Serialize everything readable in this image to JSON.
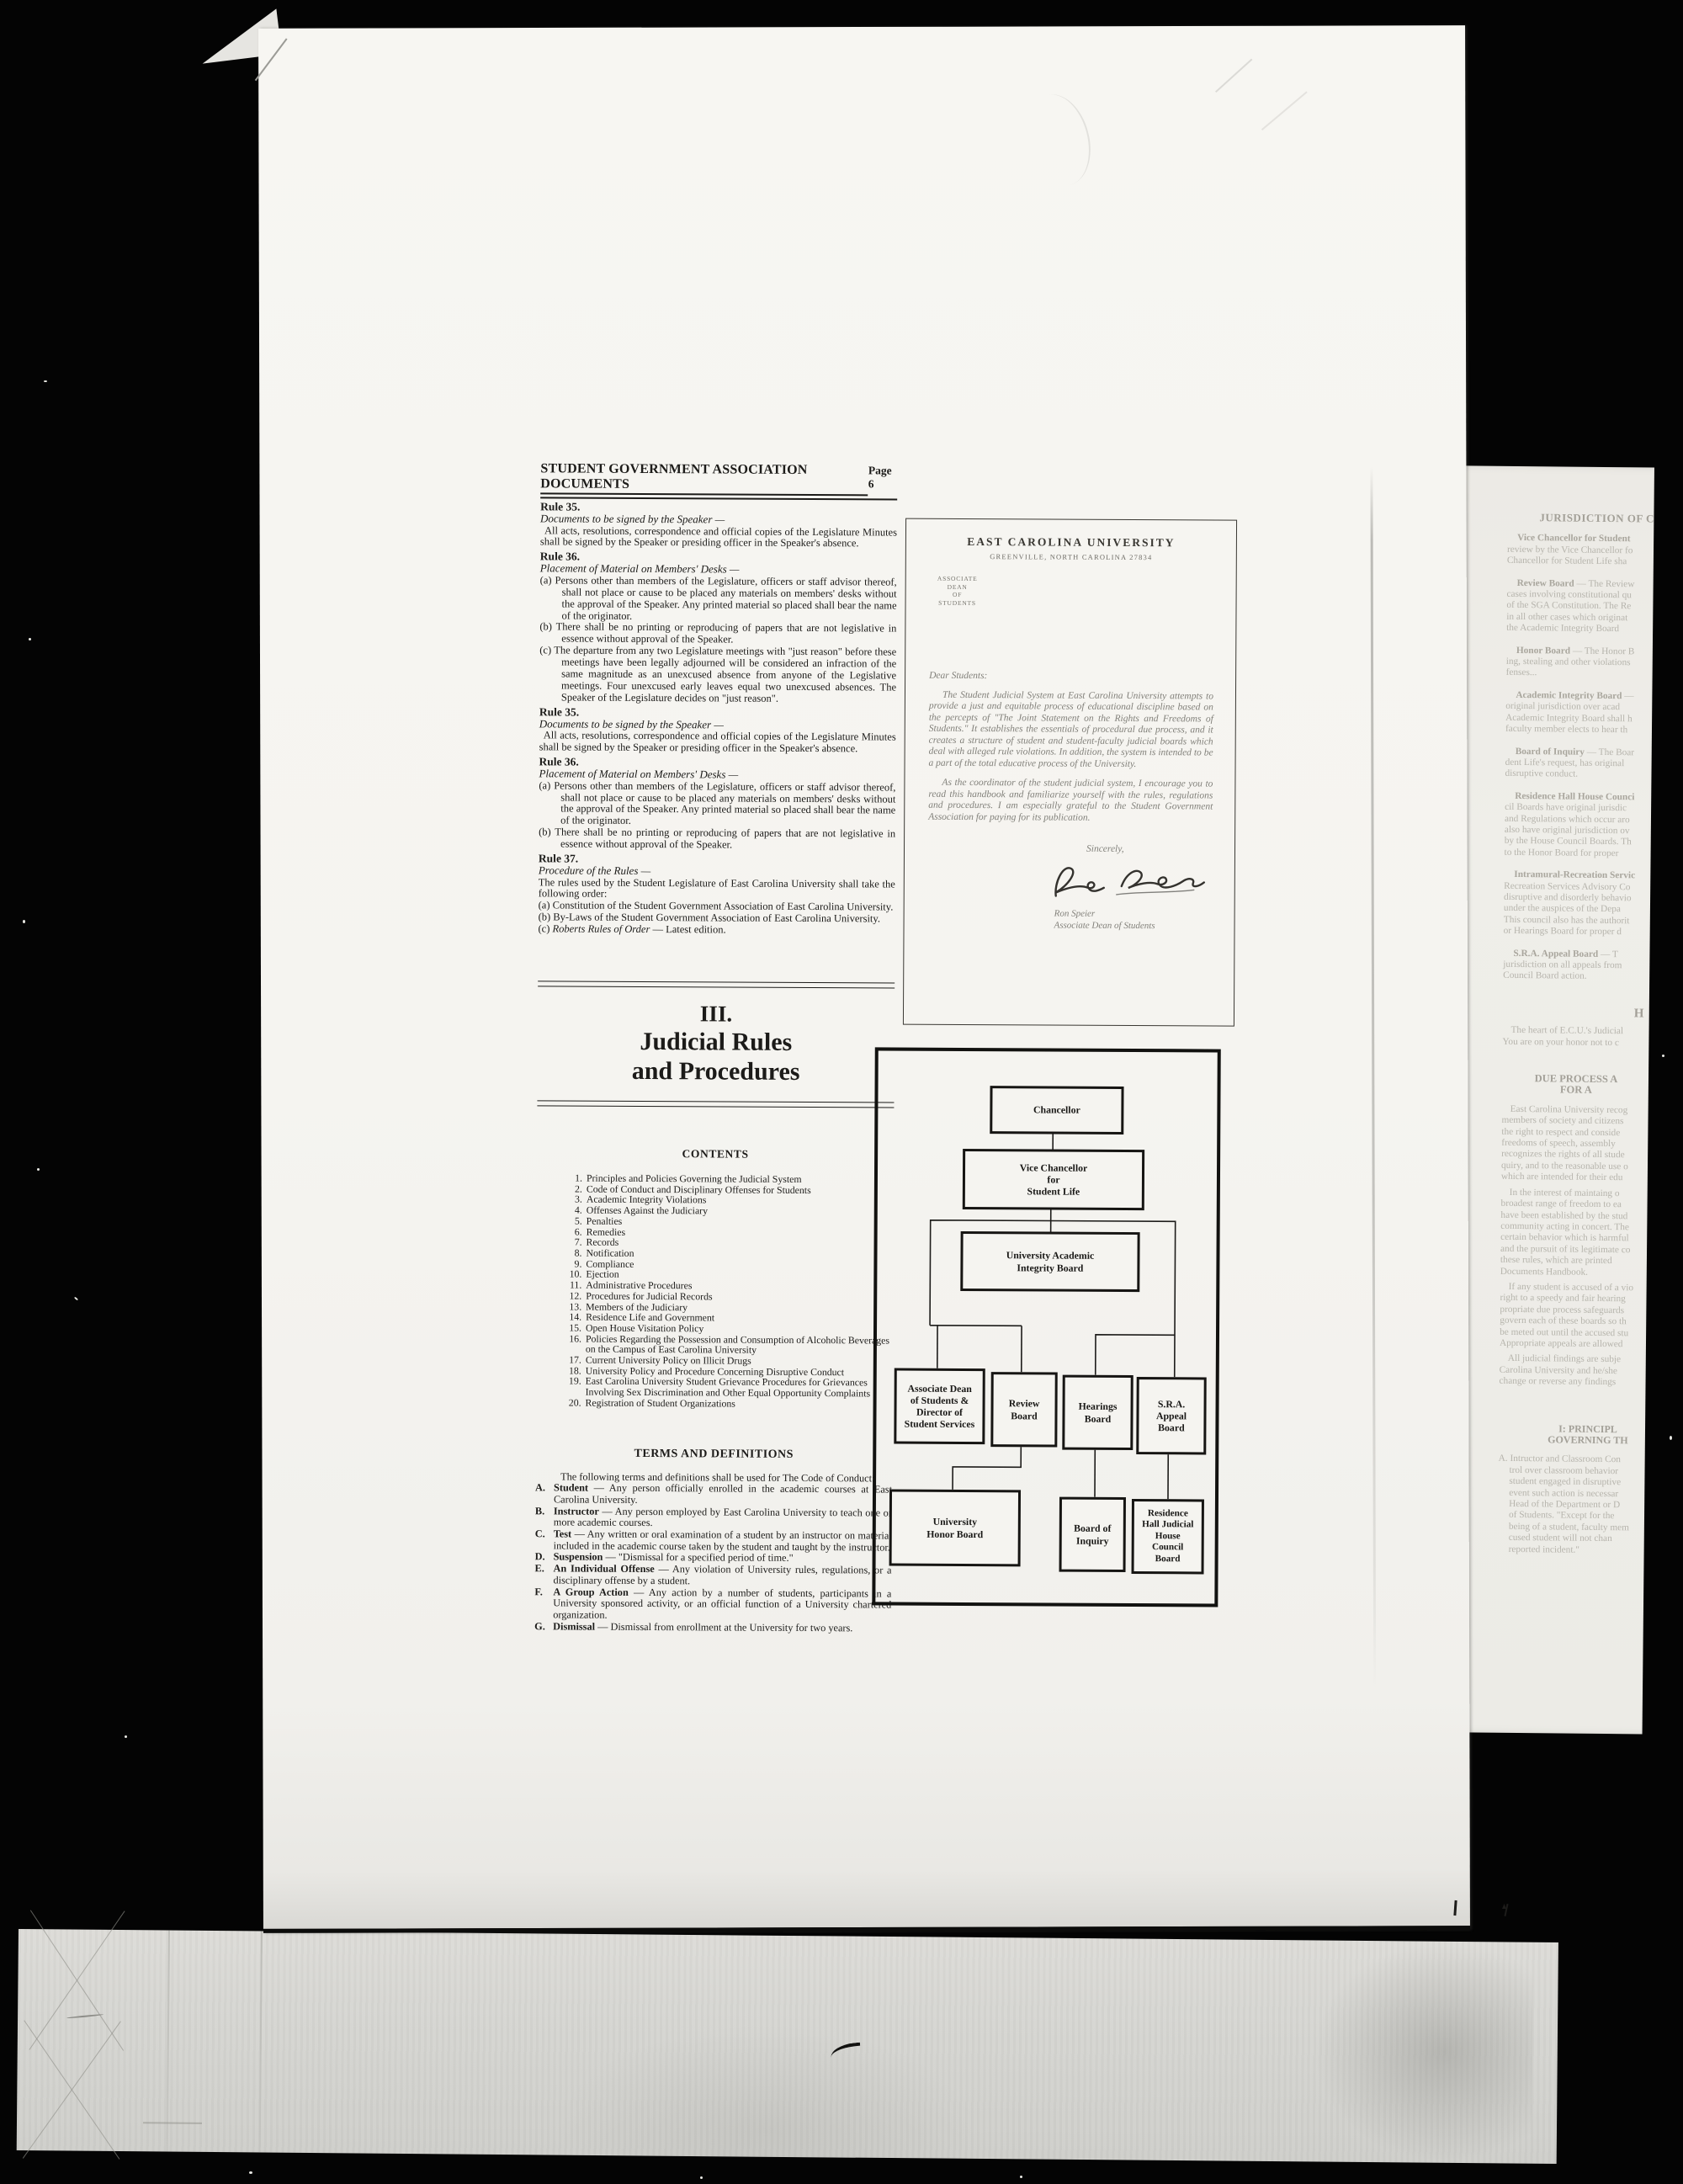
{
  "document_header": {
    "title": "STUDENT GOVERNMENT ASSOCIATION DOCUMENTS",
    "page_label": "Page 6"
  },
  "rules": {
    "r1_h": "Rule 35.",
    "r1_i": "Documents to be signed by the Speaker —",
    "r1_p": "All acts, resolutions, correspondence and official copies of the Legislature Minutes shall be signed by the Speaker or presiding officer in the Speaker's absence.",
    "r2_h": "Rule 36.",
    "r2_i": "Placement of Material on Members' Desks —",
    "r2_a": "(a) Persons other than members of the Legislature, officers or staff advisor thereof, shall not place or cause to be placed any materials on members' desks without the approval of the Speaker. Any printed material so placed shall bear the name of the originator.",
    "r2_b": "(b) There shall be no printing or reproducing of papers that are not legislative in essence without approval of the Speaker.",
    "r2_c": "(c) The departure from any two Legislature meetings with \"just reason\" before these meetings have been legally adjourned will be considered an infraction of the same magnitude as an unexcused absence from anyone of the Legislative meetings.  Four unexcused early leaves equal two unexcused absences.  The Speaker of the Legislature decides on \"just reason\".",
    "r3_h": "Rule 35.",
    "r3_i": "Documents to be signed by the Speaker —",
    "r3_p": "All acts, resolutions, correspondence and official copies of the Legislature Minutes shall be signed by the Speaker or presiding officer in the Speaker's absence.",
    "r4_h": "Rule 36.",
    "r4_i": "Placement of Material on Members' Desks —",
    "r4_a": "(a) Persons other than members of the Legislature, officers or staff advisor thereof, shall not place or cause to be placed any materials on members' desks without the approval of the Speaker. Any printed material so placed shall bear the name of the originator.",
    "r4_b": "(b) There shall be no printing or reproducing of papers that are not legislative in essence without approval of the Speaker.",
    "r5_h": "Rule 37.",
    "r5_i": "Procedure of the Rules —",
    "r5_p": "The rules used by the Student Legislature of East Carolina University shall take the following order:",
    "r5_a": "(a) Constitution of the Student Government Association of East Carolina University.",
    "r5_b": "(b) By-Laws of the Student Government Association of East Carolina University.",
    "r5_c_prefix": "(c) ",
    "r5_c_italic": "Roberts Rules of Order",
    "r5_c_rest": " — Latest edition."
  },
  "section_heading": {
    "numeral": "III.",
    "line1": "Judicial Rules",
    "line2": "and Procedures"
  },
  "contents": {
    "heading": "CONTENTS",
    "items": [
      {
        "n": "1.",
        "t": "Principles and Policies Governing the Judicial System"
      },
      {
        "n": "2.",
        "t": "Code of Conduct and Disciplinary Offenses for Students"
      },
      {
        "n": "3.",
        "t": "Academic Integrity Violations"
      },
      {
        "n": "4.",
        "t": "Offenses Against the Judiciary"
      },
      {
        "n": "5.",
        "t": "Penalties"
      },
      {
        "n": "6.",
        "t": "Remedies"
      },
      {
        "n": "7.",
        "t": "Records"
      },
      {
        "n": "8.",
        "t": "Notification"
      },
      {
        "n": "9.",
        "t": "Compliance"
      },
      {
        "n": "10.",
        "t": "Ejection"
      },
      {
        "n": "11.",
        "t": "Administrative Procedures"
      },
      {
        "n": "12.",
        "t": "Procedures for Judicial Records"
      },
      {
        "n": "13.",
        "t": "Members of the Judiciary"
      },
      {
        "n": "14.",
        "t": "Residence Life and Government"
      },
      {
        "n": "15.",
        "t": "Open House Visitation Policy"
      },
      {
        "n": "16.",
        "t": "Policies Regarding the Possession and Consumption of Alcoholic Beverages on the Campus of East Carolina University"
      },
      {
        "n": "17.",
        "t": "Current University Policy on Illicit Drugs"
      },
      {
        "n": "18.",
        "t": "University Policy and Procedure Concerning Disruptive Conduct"
      },
      {
        "n": "19.",
        "t": "East Carolina University Student Grievance Procedures for Grievances Involving Sex Discrimination and Other Equal Opportunity Complaints"
      },
      {
        "n": "20.",
        "t": "Registration of Student Organizations"
      }
    ]
  },
  "terms": {
    "heading": "TERMS AND DEFINITIONS",
    "intro": "The following terms and definitions shall be used for The Code of Conduct:",
    "items": [
      {
        "m": "A.",
        "term": "Student",
        "rest": " — Any person officially enrolled in the academic courses at East Carolina University."
      },
      {
        "m": "B.",
        "term": "Instructor",
        "rest": " — Any person employed by East Carolina University to teach one or more academic courses."
      },
      {
        "m": "C.",
        "term": "Test",
        "rest": " — Any written or oral examination of a student by an instructor on material included in the academic course taken by the student and taught by the instructor."
      },
      {
        "m": "D.",
        "term": "Suspension",
        "rest": " — \"Dismissal for a specified period of time.\""
      },
      {
        "m": "E.",
        "term": "An Individual Offense",
        "rest": " — Any violation of University rules, regulations, or a disciplinary offense by a student."
      },
      {
        "m": "F.",
        "term": "A Group Action",
        "rest": " — Any action by a number of students, participants in a University sponsored activity, or an official function of a University chartered organization."
      },
      {
        "m": "G.",
        "term": "Dismissal",
        "rest": " — Dismissal from enrollment at the University for two years."
      }
    ]
  },
  "letter": {
    "university": "EAST CAROLINA UNIVERSITY",
    "location": "GREENVILLE, NORTH CAROLINA 27834",
    "office_l1": "ASSOCIATE DEAN",
    "office_l2": "OF",
    "office_l3": "STUDENTS",
    "salutation": "Dear Students:",
    "para1": "The Student Judicial System at East Carolina University attempts to provide a just and equitable process of educational discipline based on the percepts of \"The Joint Statement on the Rights and Freedoms of Students.\" It establishes the essentials of procedural due process, and it creates a structure of student and student-faculty judicial boards which deal with alleged rule violations. In addition, the system is intended to be a part of the total educative process of the University.",
    "para2": "As the coordinator of the student judicial system, I encourage you to read this handbook and familiarize yourself with the rules, regulations and procedures. I am especially grateful to the Student Government Association for paying for its publication.",
    "closing": "Sincerely,",
    "signature": "Ron Speier",
    "signer_name": "Ron Speier",
    "signer_title": "Associate Dean of Students"
  },
  "org_chart": {
    "nodes": {
      "chancellor": "Chancellor",
      "vice_chancellor": "Vice Chancellor\nfor\nStudent Life",
      "integrity_board": "University Academic\nIntegrity Board",
      "assoc_dean": "Associate Dean\nof Students &\nDirector of\nStudent Services",
      "review_board": "Review\nBoard",
      "hearings_board": "Hearings\nBoard",
      "sra_appeal_board": "S.R.A.\nAppeal\nBoard",
      "honor_board": "University\nHonor Board",
      "board_of_inquiry": "Board of\nInquiry",
      "residence_hall_board": "Residence\nHall Judicial\nHouse\nCouncil\nBoard"
    }
  },
  "right_page": {
    "jurisdiction_header": "JURISDICTION OF C",
    "j1_lead": "Vice Chancellor for Student",
    "j1_inline": "",
    "j1_rest": "review by the Vice Chancellor fo\nChancellor for Student Life sha",
    "j2_lead": "Review Board",
    "j2_inline": " — The Review",
    "j2_rest": "cases involving constitutional qu\nof the SGA Constitution. The Re\nin all other cases which originat\nthe Academic Integrity Board",
    "j3_lead": "Honor Board",
    "j3_inline": " — The Honor B",
    "j3_rest": "ing, stealing and other violations\nfenses...",
    "j4_lead": "Academic Integrity Board",
    "j4_inline": " —",
    "j4_rest": "original jurisdiction over acad\nAcademic Integrity Board shall h\nfaculty member elects to hear th",
    "j5_lead": "Board of Inquiry",
    "j5_inline": " — The Boar",
    "j5_rest": "dent Life's request, has original\ndisruptive conduct.",
    "j6_lead": "Residence Hall House Counci",
    "j6_inline": "",
    "j6_rest": "cil Boards have original jurisdic\nand Regulations which occur aro\nalso have original jurisdiction ov\nby the House Council Boards. Th\nto the Honor Board for proper",
    "j7_lead": "Intramural-Recreation  Servic",
    "j7_inline": "",
    "j7_rest": "Recreation Services Advisory Co\ndisruptive and disorderly behavio\nunder the auspices of the Depa\nThis council also has the authorit\nor Hearings Board for proper d",
    "j8_lead": "S.R.A.  Appeal  Board",
    "j8_inline": " — T",
    "j8_rest": "jurisdiction on all appeals from\nCouncil Board action.",
    "honor_header": "H",
    "honor_text": "The heart of E.C.U.'s Judicial\nYou are on your honor not to c",
    "due_header": "DUE PROCESS A\nFOR A",
    "due_p1": "East Carolina University recog\nmembers of society and citizens\nthe right to respect and conside\nfreedoms of speech, assembly\nrecognizes the rights of all stude\nquiry, and to the reasonable use o\nwhich are intended for their edu",
    "due_p2": "In the interest of maintaing o\nbroadest range of freedom to ea\nhave been established by the stud\ncommunity acting in concert. The\ncertain behavior which is harmful\nand the pursuit of its legitimate co\nthese rules, which are printed\nDocuments Handbook.",
    "due_p3": "If any student is accused of a vio\nright to a speedy and fair hearing\npropriate due process safeguards\ngovern each of these boards so th\nbe meted out until the accused stu\nAppropriate appeals are allowed",
    "due_p4": "All judicial findings are subje\nCarolina University and he/she\nchange or reverse any findings",
    "principles_header": "I: PRINCIPL\nGOVERNING TH",
    "principles_text": "A. Intructor and Classroom Con\ntrol over classroom behavior\nstudent engaged in disruptive\nevent such action is necessar\nHead of the Department or D\nof Students. \"Except for the\nbeing of a student, faculty mem\ncused student will not chan\nreported incident.\""
  },
  "colors": {
    "background": "#040404",
    "paper": "#f5f4f0",
    "paper_shadowed": "#eceae5",
    "backing_strip": "#d6d6d2",
    "ink": "#1c1b19",
    "letter_ink": "#82807a",
    "faint_ink": "#b6b4ac"
  }
}
